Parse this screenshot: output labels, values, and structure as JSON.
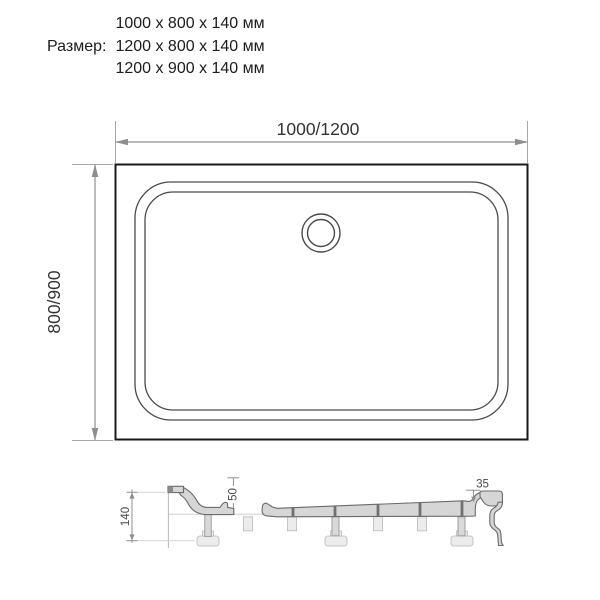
{
  "header": {
    "label": "Размер:",
    "sizes": [
      "1000 x 800 x 140 мм",
      "1200 x 800 x 140 мм",
      "1200 x 900 x 140 мм"
    ]
  },
  "plan_view": {
    "width_dimension": "1000/1200",
    "height_dimension": "800/900"
  },
  "cross_section": {
    "total_height_dimension": "140",
    "inner_depth_dimension": "50",
    "rim_height_dimension": "35"
  },
  "colors": {
    "outline_dark": "#1a1a1a",
    "drawing_line": "#4a4a4a",
    "dimension_line": "#8f8f8f",
    "extension_line": "#a8a8a8",
    "section_fill": "#d6d6d6",
    "support_fill": "#ececec",
    "background": "#ffffff"
  }
}
